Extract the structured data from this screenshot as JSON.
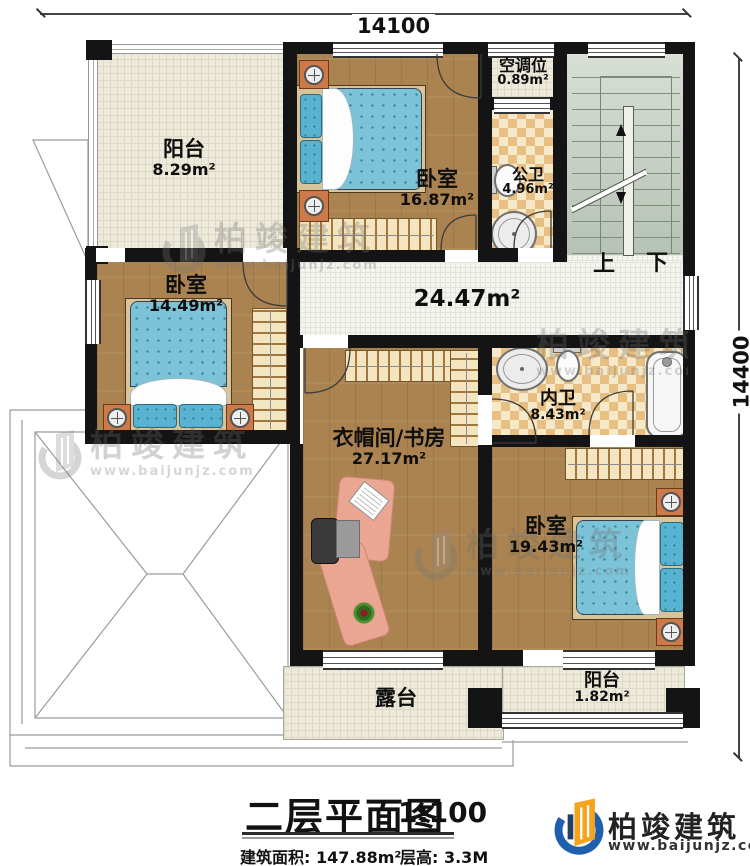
{
  "plan": {
    "dim_top": "14100",
    "dim_right": "14400",
    "stairs_up": "上",
    "stairs_down": "下",
    "rooms": {
      "balcony_tl": {
        "name": "阳台",
        "area": "8.29m²"
      },
      "bedroom_top": {
        "name": "卧室",
        "area": "16.87m²"
      },
      "ac": {
        "name": "空调位",
        "area": "0.89m²"
      },
      "bath_public": {
        "name": "公卫",
        "area": "4.96m²"
      },
      "bedroom_left": {
        "name": "卧室",
        "area": "14.49m²"
      },
      "corridor": {
        "area": "24.47m²"
      },
      "study": {
        "name": "衣帽间/书房",
        "area": "27.17m²"
      },
      "bath_private": {
        "name": "内卫",
        "area": "8.43m²"
      },
      "bedroom_br": {
        "name": "卧室",
        "area": "19.43m²"
      },
      "terrace": {
        "name": "露台"
      },
      "balcony_br": {
        "name": "阳台",
        "area": "1.82m²"
      }
    }
  },
  "titleblock": {
    "title": "二层平面图",
    "scale": "1:100",
    "area": "建筑面积: 147.88m²",
    "floor_height": "层高: 3.3M"
  },
  "brand": {
    "name": "柏竣建筑",
    "website": "www.baijunjz.com"
  },
  "watermark": {
    "name": "柏竣建筑",
    "website": "www.baijunjz.com"
  },
  "colors": {
    "wall": "#141414",
    "wood_floor": "#aa8350",
    "tile_checker": "#e7bf82",
    "stair_fill": "#c5cfc4",
    "brand_blue": "#1e5fae",
    "brand_orange": "#f5a21d"
  }
}
